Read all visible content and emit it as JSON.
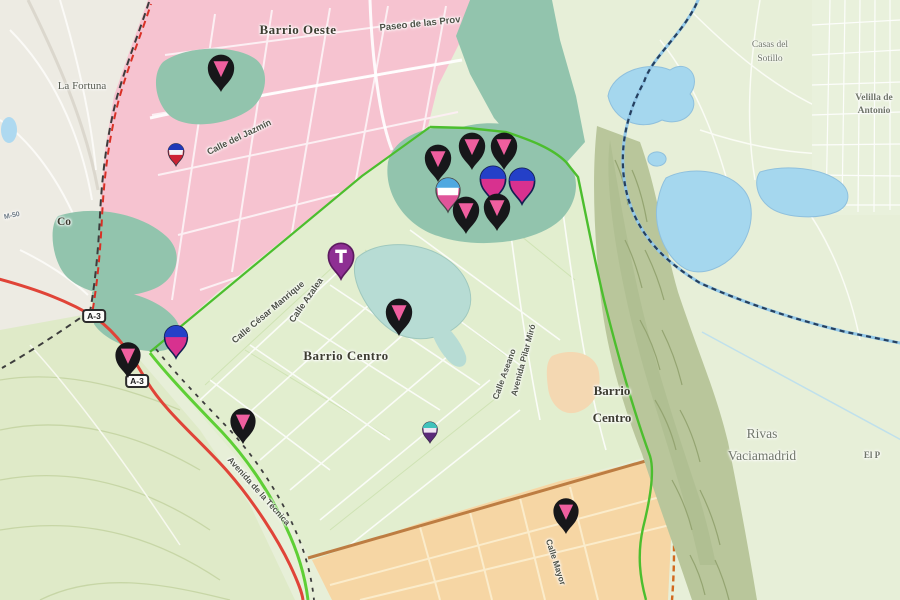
{
  "map": {
    "colors": {
      "rural_green": "#e7efd8",
      "district_pink": "#f6c3d0",
      "district_green": "#e2eecf",
      "district_orange": "#f6d6a4",
      "park_teal": "#92c4ad",
      "pond_teal": "#b7dcd4",
      "lake_blue": "#a5d7ee",
      "hills_olive": "#b9c69b",
      "road_red": "#e04438",
      "boundary_green": "#4cbe2e",
      "boundary_navy": "#26405f",
      "urban_gray": "#edebe3"
    },
    "place_labels": [
      {
        "id": "barrio-oeste",
        "lines": [
          "Barrio Oeste"
        ],
        "x": 298,
        "y": 30,
        "rot": 0,
        "size": 13,
        "weight": 700,
        "font": "serif",
        "color": "#3c3c30",
        "ls": 0.5
      },
      {
        "id": "paseo-de-las-provincias",
        "lines": [
          "Paseo de las Prov"
        ],
        "x": 420,
        "y": 24,
        "rot": -6,
        "size": 9.5,
        "weight": 700,
        "font": "sans",
        "color": "#4c5146"
      },
      {
        "id": "la-fortuna",
        "lines": [
          "La Fortuna"
        ],
        "x": 82,
        "y": 86,
        "rot": 0,
        "size": 11,
        "weight": 400,
        "font": "serif",
        "color": "#565a50"
      },
      {
        "id": "m-50",
        "lines": [
          "M-50"
        ],
        "x": 12,
        "y": 216,
        "rot": -12,
        "size": 7,
        "weight": 700,
        "font": "sans",
        "color": "#6d7a86"
      },
      {
        "id": "covibar-partial",
        "lines": [
          "Co"
        ],
        "x": 64,
        "y": 222,
        "rot": 0,
        "size": 11.5,
        "weight": 700,
        "font": "serif",
        "color": "#3c3c30"
      },
      {
        "id": "calle-del-jazmin",
        "lines": [
          "Calle del Jazmín"
        ],
        "x": 239,
        "y": 137,
        "rot": -26,
        "size": 9,
        "weight": 600,
        "font": "sans",
        "color": "#4c5146"
      },
      {
        "id": "calle-cesar-manrique",
        "lines": [
          "Calle César Manrique"
        ],
        "x": 268,
        "y": 312,
        "rot": -40,
        "size": 9,
        "weight": 600,
        "font": "sans",
        "color": "#4c5146"
      },
      {
        "id": "calle-azalea",
        "lines": [
          "Calle Azalea"
        ],
        "x": 306,
        "y": 300,
        "rot": -55,
        "size": 9,
        "weight": 600,
        "font": "sans",
        "color": "#4c5146"
      },
      {
        "id": "barrio-centro",
        "lines": [
          "Barrio Centro"
        ],
        "x": 346,
        "y": 356,
        "rot": 0,
        "size": 13,
        "weight": 700,
        "font": "serif",
        "color": "#3c3c30",
        "ls": 0.5
      },
      {
        "id": "calle-aseano",
        "lines": [
          "Calle Aseano"
        ],
        "x": 504,
        "y": 374,
        "rot": -70,
        "size": 8.5,
        "weight": 600,
        "font": "sans",
        "color": "#4c5146"
      },
      {
        "id": "avenida-pilar-miro",
        "lines": [
          "Avenida Pilar Miró"
        ],
        "x": 523,
        "y": 360,
        "rot": -75,
        "size": 8.5,
        "weight": 600,
        "font": "sans",
        "color": "#4c5146"
      },
      {
        "id": "barrio-centro-east",
        "lines": [
          "Barrio",
          "Centro"
        ],
        "x": 612,
        "y": 404,
        "rot": 0,
        "size": 13,
        "weight": 700,
        "font": "serif",
        "color": "#3c3c30",
        "lh": 27
      },
      {
        "id": "rivas-vaciamadrid",
        "lines": [
          "Rivas",
          "Vaciamadrid"
        ],
        "x": 762,
        "y": 445,
        "rot": 0,
        "size": 13.5,
        "weight": 400,
        "font": "serif",
        "color": "#70766a",
        "lh": 22
      },
      {
        "id": "casas-del-sotillo",
        "lines": [
          "Casas del",
          "Sotillo"
        ],
        "x": 770,
        "y": 52,
        "rot": 0,
        "size": 9.5,
        "weight": 400,
        "font": "serif",
        "color": "#70766a",
        "lh": 14
      },
      {
        "id": "velilla-de-antonio",
        "lines": [
          "Velilla de",
          "Antonio"
        ],
        "x": 874,
        "y": 105,
        "rot": 0,
        "size": 9.5,
        "weight": 700,
        "font": "serif",
        "color": "#70766a",
        "lh": 13
      },
      {
        "id": "avenida-de-la-tecnica",
        "lines": [
          "Avenida de la Técnica"
        ],
        "x": 259,
        "y": 491,
        "rot": 48,
        "size": 8.5,
        "weight": 600,
        "font": "sans",
        "color": "#4c5146"
      },
      {
        "id": "calle-mayor",
        "lines": [
          "Calle Mayor"
        ],
        "x": 556,
        "y": 562,
        "rot": 72,
        "size": 8.5,
        "weight": 600,
        "font": "sans",
        "color": "#4c5146"
      },
      {
        "id": "el-porcal-partial",
        "lines": [
          "El P"
        ],
        "x": 872,
        "y": 455,
        "rot": 0,
        "size": 9,
        "weight": 700,
        "font": "serif",
        "color": "#70766a"
      }
    ],
    "road_shields": [
      {
        "id": "a3-north",
        "label": "A-3",
        "x": 94,
        "y": 316
      },
      {
        "id": "a3-south",
        "label": "A-3",
        "x": 137,
        "y": 381
      }
    ],
    "pin_styles": {
      "black-pink": {
        "body": "#17171a",
        "accent": "#ef5f9f"
      },
      "blue-pink": {
        "body": "#d8318f",
        "cap": "#2440c8",
        "outline": "#131f52"
      },
      "blue-white-pink": {
        "top": "#4fa8e0",
        "mid": "#ffffff",
        "bottom": "#e0559a",
        "outline": "#4a4a4a"
      },
      "navy-white-red": {
        "top": "#2038b8",
        "mid": "#f5f5f5",
        "bottom": "#cc2233",
        "outline": "#333344"
      },
      "teal-white-purple": {
        "top": "#41c2bb",
        "mid": "#efe4f2",
        "bottom": "#5a2a78",
        "outline": "#3a2a4a"
      },
      "purple-t": {
        "body": "#8e2f93",
        "outline": "#5c1b60",
        "glyph": "T",
        "glyph_color": "#ffffff"
      }
    },
    "pins": [
      {
        "id": "oeste-park",
        "type": "black-pink",
        "x": 221,
        "y": 92,
        "s": 1.1
      },
      {
        "id": "jazmin-small",
        "type": "navy-white-red",
        "x": 176,
        "y": 166,
        "s": 0.66
      },
      {
        "id": "cluster-1",
        "type": "black-pink",
        "x": 438,
        "y": 182,
        "s": 1.1
      },
      {
        "id": "cluster-2",
        "type": "black-pink",
        "x": 472,
        "y": 170,
        "s": 1.1
      },
      {
        "id": "cluster-3",
        "type": "black-pink",
        "x": 504,
        "y": 170,
        "s": 1.1
      },
      {
        "id": "cluster-4",
        "type": "blue-pink",
        "x": 493,
        "y": 202,
        "s": 1.05
      },
      {
        "id": "cluster-5",
        "type": "blue-pink",
        "x": 522,
        "y": 204,
        "s": 1.05
      },
      {
        "id": "cluster-6",
        "type": "blue-white-pink",
        "x": 448,
        "y": 212,
        "s": 1.0
      },
      {
        "id": "cluster-7",
        "type": "black-pink",
        "x": 466,
        "y": 234,
        "s": 1.1
      },
      {
        "id": "cluster-8",
        "type": "black-pink",
        "x": 497,
        "y": 231,
        "s": 1.1
      },
      {
        "id": "manrique",
        "type": "purple-t",
        "x": 341,
        "y": 279,
        "s": 1.05
      },
      {
        "id": "pond",
        "type": "black-pink",
        "x": 399,
        "y": 336,
        "s": 1.1
      },
      {
        "id": "a3-blue",
        "type": "blue-pink",
        "x": 176,
        "y": 358,
        "s": 0.95
      },
      {
        "id": "a3",
        "type": "black-pink",
        "x": 128,
        "y": 378,
        "s": 1.05
      },
      {
        "id": "tecnica",
        "type": "black-pink",
        "x": 243,
        "y": 444,
        "s": 1.05
      },
      {
        "id": "centro-small",
        "type": "teal-white-purple",
        "x": 430,
        "y": 443,
        "s": 0.62
      },
      {
        "id": "mayor",
        "type": "black-pink",
        "x": 566,
        "y": 534,
        "s": 1.05
      }
    ]
  }
}
